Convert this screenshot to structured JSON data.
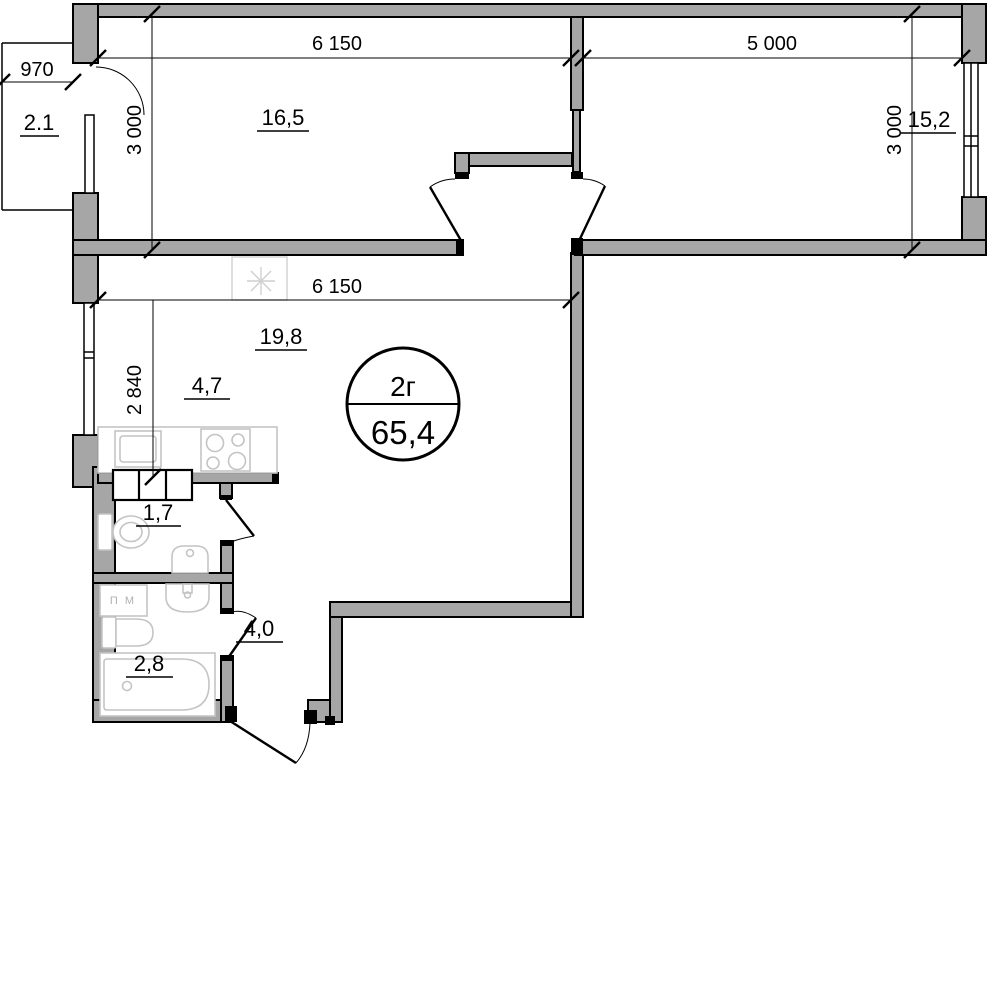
{
  "plan": {
    "title_stamp": {
      "flat_type": "2г",
      "total_area": "65,4"
    },
    "dimensions_mm": {
      "balcony_width": "970",
      "bedroom1_width": "6 150",
      "bedroom2_width": "5 000",
      "bedroom1_depth": "3 000",
      "bedroom2_depth": "3 000",
      "living_width": "6 150",
      "kitchen_depth": "2 840"
    },
    "areas_m2": {
      "balcony": "2.1",
      "bedroom1": "16,5",
      "bedroom2": "15,2",
      "living_kitchen": "19,8",
      "kitchen_zone": "4,7",
      "wc": "1,7",
      "bathroom": "2,8",
      "hallway": "4,0"
    },
    "fixtures": {
      "washing_machine_label": "П М"
    },
    "colors": {
      "wall_fill": "#a6a6a6",
      "line": "#000000",
      "fixture_line": "#c4c4c4"
    }
  }
}
